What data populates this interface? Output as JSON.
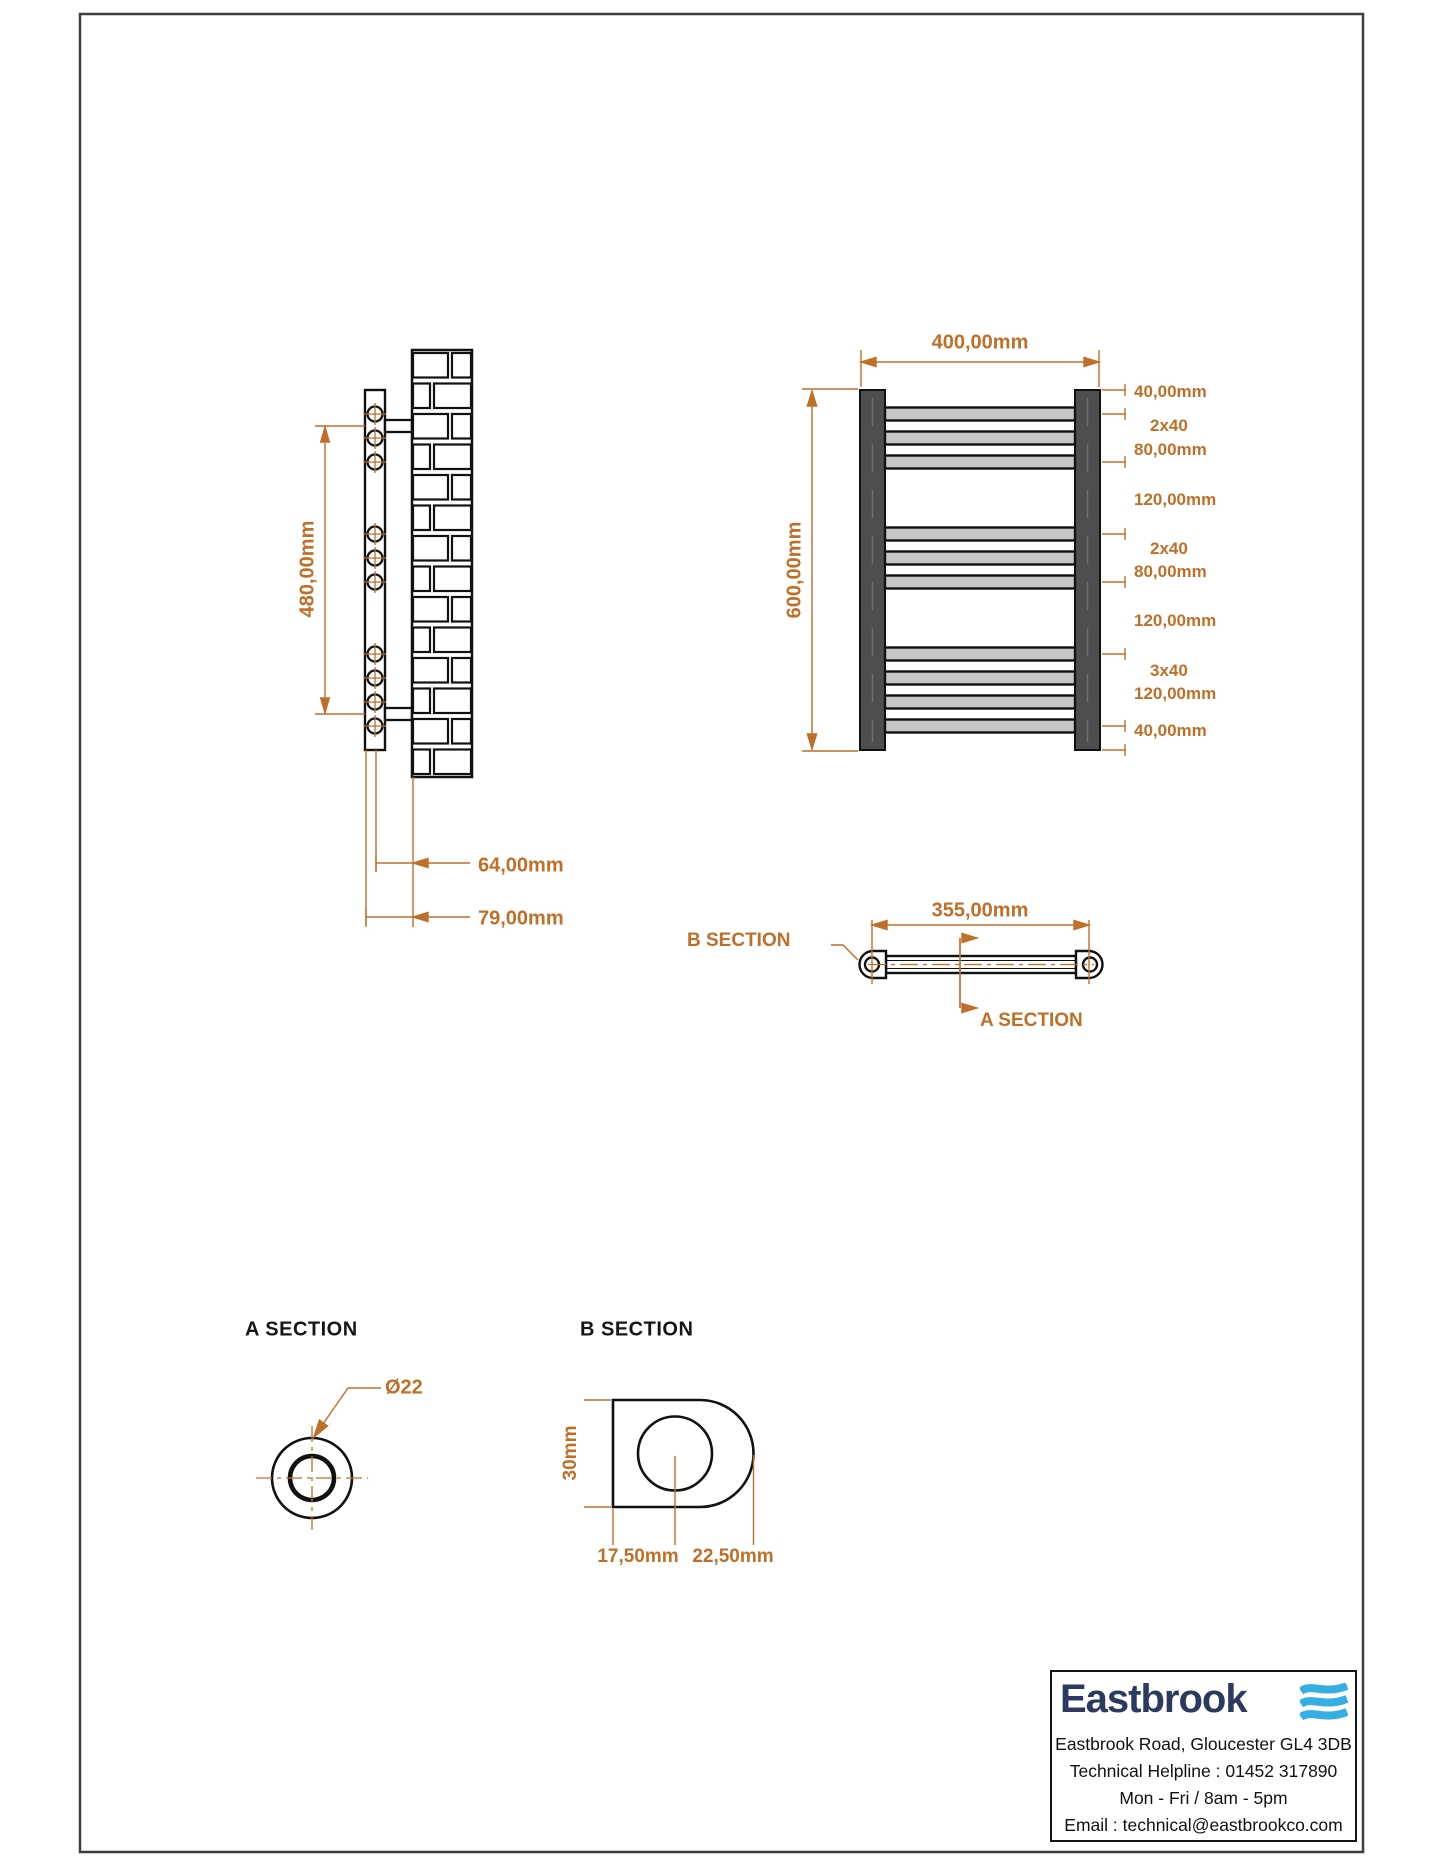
{
  "drawing": {
    "side_view": {
      "bracket_spacing": "480,00mm",
      "center_to_wall": "64,00mm",
      "face_to_wall": "79,00mm"
    },
    "front_view": {
      "width": "400,00mm",
      "height": "600,00mm",
      "chain": [
        "40,00mm",
        "2x40",
        "80,00mm",
        "120,00mm",
        "2x40",
        "80,00mm",
        "120,00mm",
        "3x40",
        "120,00mm",
        "40,00mm"
      ]
    },
    "tube_view": {
      "pipe_centres": "355,00mm",
      "b_label": "B SECTION",
      "a_label": "A SECTION"
    },
    "a_section": {
      "title": "A SECTION",
      "diameter": "Ø22"
    },
    "b_section": {
      "title": "B SECTION",
      "height": "30mm",
      "centre": "17,50mm",
      "depth": "22,50mm"
    }
  },
  "footer": {
    "brand": "Eastbrook",
    "address": "Eastbrook Road, Gloucester GL4 3DB",
    "helpline": "Technical Helpline : 01452 317890",
    "hours": "Mon - Fri / 8am - 5pm",
    "email": "Email : technical@eastbrookco.com"
  },
  "colors": {
    "dimension_orange": "#c06f28",
    "logo_navy": "#2b3a5e",
    "logo_blue": "#35aee3",
    "rail_dark": "#4e4e4e",
    "rung_grey": "#c6c6c6"
  }
}
